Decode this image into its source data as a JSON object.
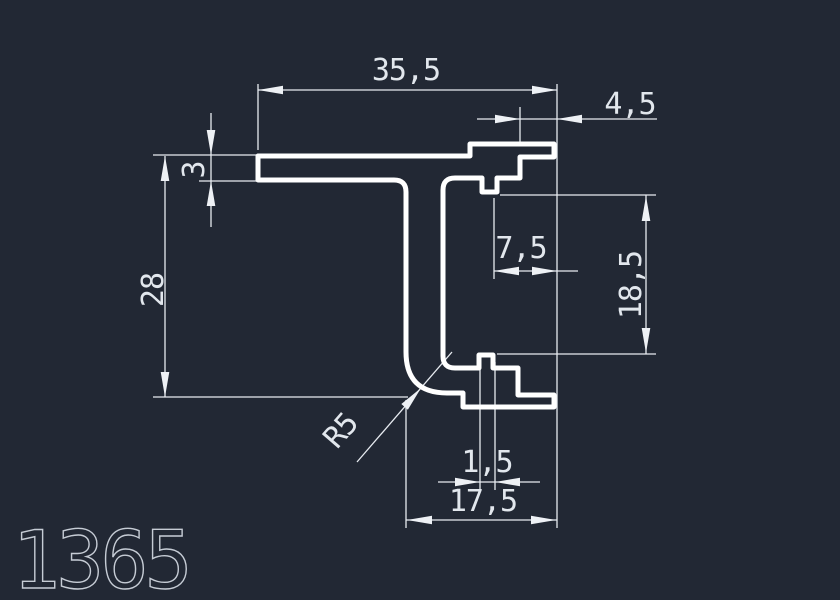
{
  "window": {
    "background_color": "#222834"
  },
  "drawing": {
    "part_number": "1365",
    "profile_color": "#ffffff",
    "dimension_color": "#e8ecf1",
    "dimensions": {
      "top_width": "35,5",
      "lip_width": "4,5",
      "flange_thickness": "3",
      "total_height": "28",
      "hook_depth": "7,5",
      "channel_height": "18,5",
      "corner_radius": "R5",
      "tab_width": "1,5",
      "foot_width": "17,5"
    }
  }
}
